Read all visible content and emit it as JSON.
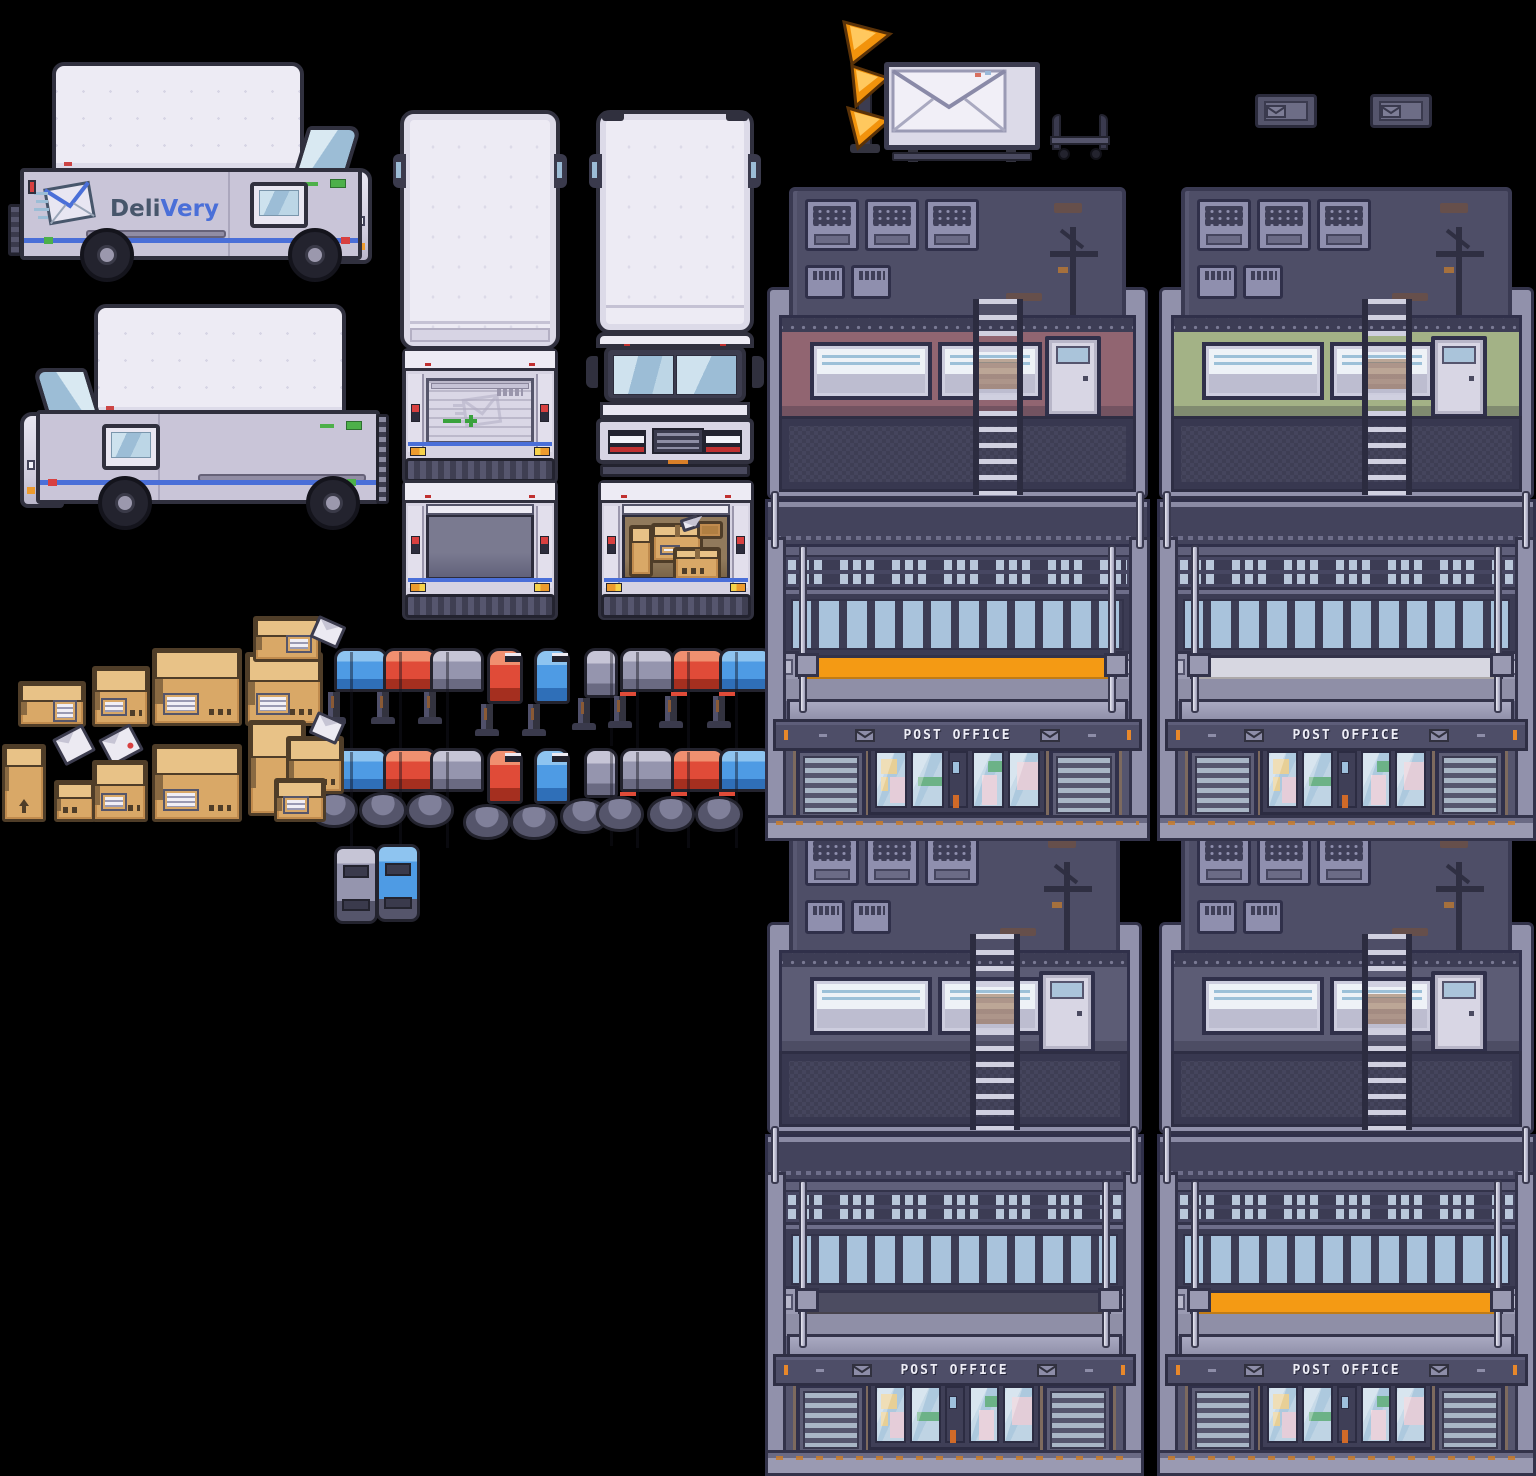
{
  "meta": {
    "title": "Delivery & Post Office pixel-art sprite sheet",
    "canvas": {
      "width": 1536,
      "height": 1440
    },
    "background": "#000000"
  },
  "palette": {
    "outline": "#30303e",
    "truck_white": "#edebf4",
    "truck_gray_panel": "#c9c5d8",
    "window_blue": "#9cbdd6",
    "stripe_blue": "#4a6fd8",
    "accent_red": "#d84040",
    "accent_green": "#4db04a",
    "accent_orange": "#ed9b2d",
    "box_tan": "#d9a867",
    "mailbox_blue": "#4e9be4",
    "mailbox_red": "#e04b38",
    "mailbox_gray": "#9595ae",
    "building_wall": "#60607b",
    "building_light": "#9191ab",
    "post_office_orange": "#f49a14"
  },
  "branding": {
    "logo_prefix": "Deli",
    "logo_suffix": "Very"
  },
  "post_office": {
    "sign_text": "POST OFFICE",
    "buildings": [
      {
        "id": "post-office-building-1",
        "x": 765,
        "y": 187,
        "w": 385,
        "accent": "#916571",
        "stripe": "#f49a14"
      },
      {
        "id": "post-office-building-2",
        "x": 1157,
        "y": 187,
        "w": 379,
        "accent": "#a3b286",
        "stripe": "#d7d7e1"
      },
      {
        "id": "post-office-building-3",
        "x": 765,
        "y": 822,
        "w": 379,
        "accent": "#5c5c75",
        "stripe": "#4c4c61"
      },
      {
        "id": "post-office-building-4",
        "x": 1157,
        "y": 822,
        "w": 379,
        "accent": "#5c5c75",
        "stripe": "#f49a14"
      }
    ]
  },
  "trucks": [
    {
      "id": "van-side-right",
      "label": "delivery van side view facing right with logo"
    },
    {
      "id": "van-side-left",
      "label": "delivery van side view facing left"
    },
    {
      "id": "truck-top-rear",
      "label": "box truck top view (rear orientation)"
    },
    {
      "id": "truck-rear-closed",
      "label": "box truck rear view, door closed with envelope watermark"
    },
    {
      "id": "truck-rear-open-empty",
      "label": "box truck rear view, door open, empty"
    },
    {
      "id": "truck-top-front",
      "label": "box truck top view (front orientation)"
    },
    {
      "id": "truck-front",
      "label": "box truck front view with windshield and grille"
    },
    {
      "id": "truck-rear-open-boxes",
      "label": "box truck rear view, door open, loaded with parcels"
    }
  ],
  "mailboxes": {
    "rows": [
      {
        "y": 648,
        "base": "post",
        "items": [
          {
            "x": 334,
            "color": "blue",
            "view": "side"
          },
          {
            "x": 383,
            "color": "red",
            "view": "side"
          },
          {
            "x": 430,
            "color": "gray",
            "view": "side"
          },
          {
            "x": 487,
            "color": "red",
            "view": "front"
          },
          {
            "x": 534,
            "color": "blue",
            "view": "front"
          },
          {
            "x": 584,
            "color": "gray",
            "view": "back"
          },
          {
            "x": 620,
            "color": "gray",
            "view": "side",
            "flag": true
          },
          {
            "x": 671,
            "color": "red",
            "view": "side",
            "flag": true
          },
          {
            "x": 719,
            "color": "blue",
            "view": "side",
            "flag": true
          }
        ]
      },
      {
        "y": 748,
        "base": "pedestal",
        "items": [
          {
            "x": 334,
            "color": "blue",
            "view": "side"
          },
          {
            "x": 383,
            "color": "red",
            "view": "side"
          },
          {
            "x": 430,
            "color": "gray",
            "view": "side"
          },
          {
            "x": 487,
            "color": "red",
            "view": "front"
          },
          {
            "x": 534,
            "color": "blue",
            "view": "front"
          },
          {
            "x": 584,
            "color": "gray",
            "view": "back"
          },
          {
            "x": 620,
            "color": "gray",
            "view": "side",
            "flag": true
          },
          {
            "x": 671,
            "color": "red",
            "view": "side",
            "flag": true
          },
          {
            "x": 719,
            "color": "blue",
            "view": "side",
            "flag": true
          }
        ]
      }
    ],
    "top_view": [
      {
        "x": 334,
        "y": 846,
        "color": "gray"
      },
      {
        "x": 376,
        "y": 844,
        "color": "blue"
      }
    ]
  },
  "packages": [
    {
      "type": "box-flat",
      "x": 18,
      "y": 681,
      "w": 62,
      "h": 40
    },
    {
      "type": "box-cube",
      "x": 92,
      "y": 666,
      "w": 52,
      "h": 55
    },
    {
      "type": "box-large",
      "x": 152,
      "y": 648,
      "w": 84,
      "h": 72
    },
    {
      "type": "stack-a",
      "x": 243,
      "y": 616,
      "w": 96,
      "h": 104
    },
    {
      "type": "envelope",
      "x": 57,
      "y": 730,
      "w": 28,
      "h": 24
    },
    {
      "type": "envelope-stamp",
      "x": 103,
      "y": 730,
      "w": 30,
      "h": 24
    },
    {
      "type": "box-tall",
      "x": 2,
      "y": 744,
      "w": 38,
      "h": 72
    },
    {
      "type": "box-small",
      "x": 54,
      "y": 780,
      "w": 36,
      "h": 36
    },
    {
      "type": "box-cube",
      "x": 92,
      "y": 760,
      "w": 50,
      "h": 56
    },
    {
      "type": "box-large",
      "x": 152,
      "y": 744,
      "w": 84,
      "h": 72
    },
    {
      "type": "stack-b",
      "x": 244,
      "y": 720,
      "w": 94,
      "h": 97
    }
  ],
  "props": [
    {
      "id": "chevron-sign",
      "label": "orange triple-arrow street sign"
    },
    {
      "id": "envelope-billboard",
      "label": "envelope sign board on stand"
    },
    {
      "id": "luggage-cart",
      "label": "parcel hand cart"
    },
    {
      "id": "mail-plaque-1",
      "label": "wall plaque with envelope icon"
    },
    {
      "id": "mail-plaque-2",
      "label": "wall plaque with envelope icon"
    }
  ]
}
